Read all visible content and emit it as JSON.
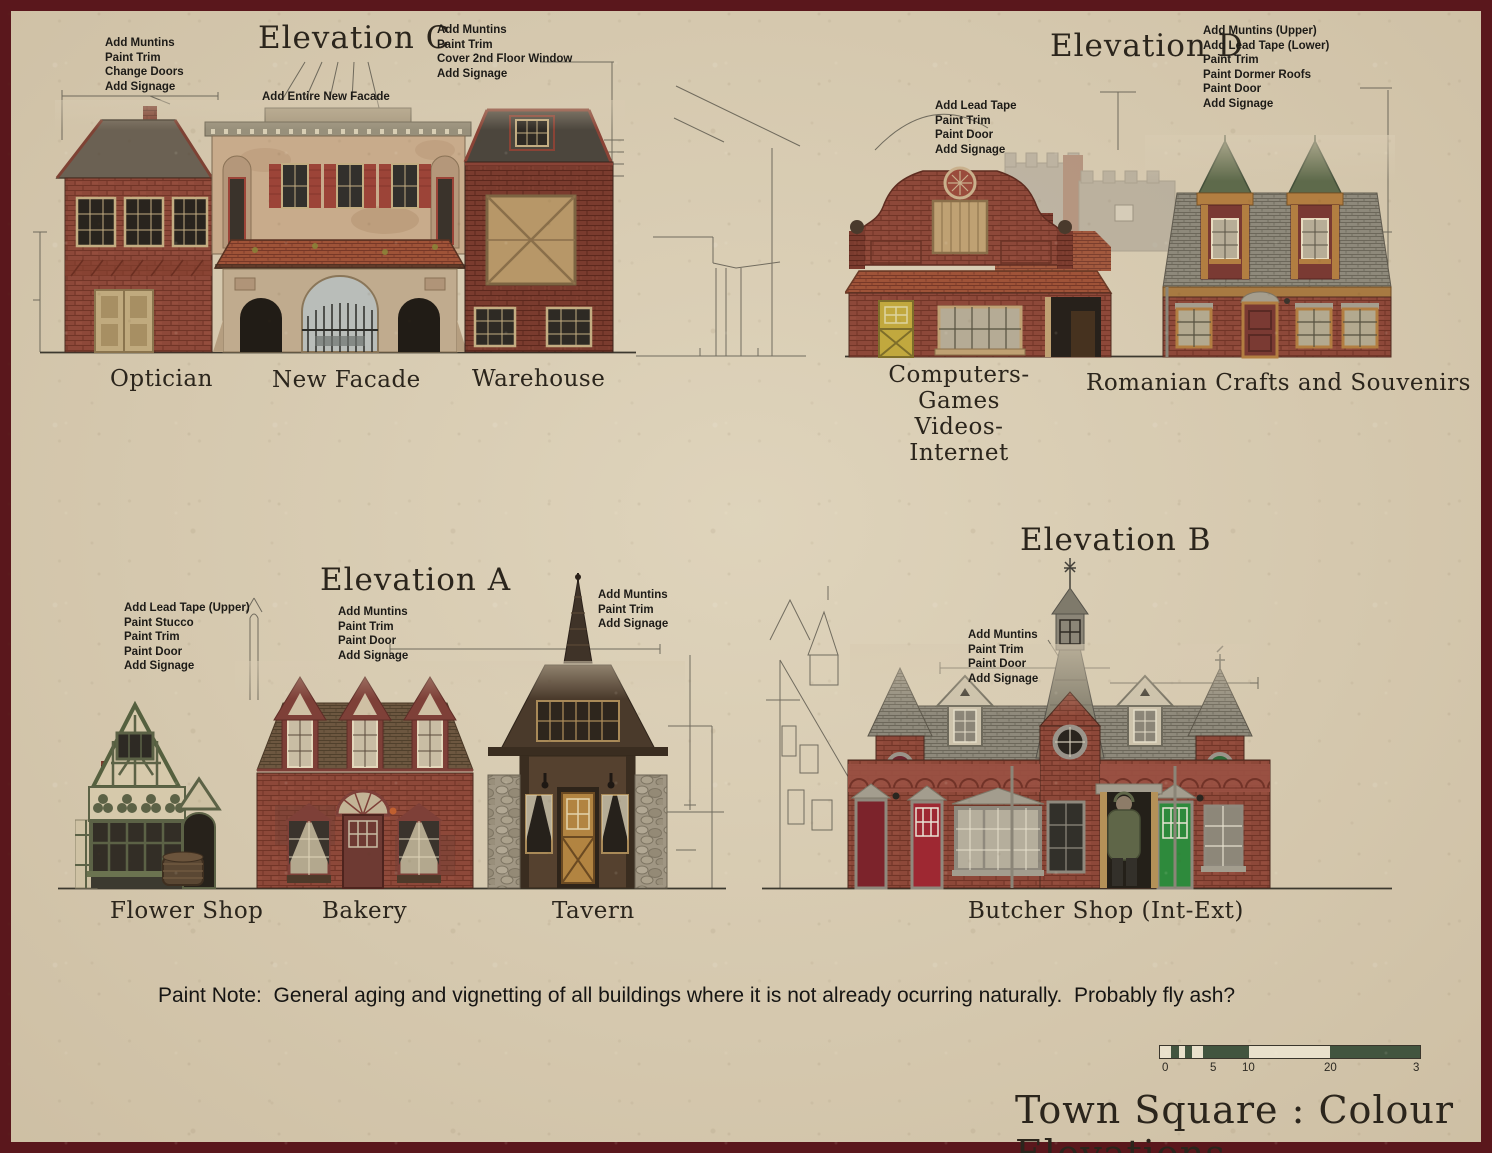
{
  "page": {
    "main_title": "Town Square : Colour Elevations",
    "paint_note": "Paint Note:  General aging and vignetting of all buildings where it is not already ocurring naturally.  Probably fly ash?"
  },
  "scale_bar": {
    "ticks": [
      "0",
      "5",
      "10",
      "20",
      "3"
    ]
  },
  "elevations": {
    "c": {
      "title": "Elevation C",
      "ann_left": "Add Muntins\nPaint Trim\nChange Doors\nAdd Signage",
      "ann_center": "Add Entire New Facade",
      "ann_right": "Add Muntins\nPaint Trim\nCover 2nd Floor Window\nAdd Signage",
      "labels": {
        "optician": "Optician",
        "new_facade": "New Facade",
        "warehouse": "Warehouse"
      }
    },
    "d": {
      "title": "Elevation D",
      "ann_left": "Add Lead Tape\nPaint Trim\nPaint Door\nAdd Signage",
      "ann_right": "Add Muntins (Upper)\nAdd Lead Tape (Lower)\nPaint Trim\nPaint Dormer Roofs\nPaint Door\nAdd Signage",
      "labels": {
        "computers": "Computers-Games\nVideos-Internet",
        "romanian": "Romanian Crafts and Souvenirs"
      }
    },
    "a": {
      "title": "Elevation A",
      "ann_left": "Add Lead Tape (Upper)\nPaint Stucco\nPaint Trim\nPaint Door\nAdd Signage",
      "ann_center": "Add Muntins\nPaint Trim\nPaint Door\nAdd Signage",
      "ann_right": "Add Muntins\nPaint Trim\nAdd Signage",
      "labels": {
        "flower_shop": "Flower Shop",
        "bakery": "Bakery",
        "tavern": "Tavern"
      }
    },
    "b": {
      "title": "Elevation B",
      "ann_left": "Add Muntins\nPaint Trim\nPaint Door\nAdd Signage",
      "labels": {
        "butcher": "Butcher Shop (Int-Ext)"
      }
    }
  }
}
